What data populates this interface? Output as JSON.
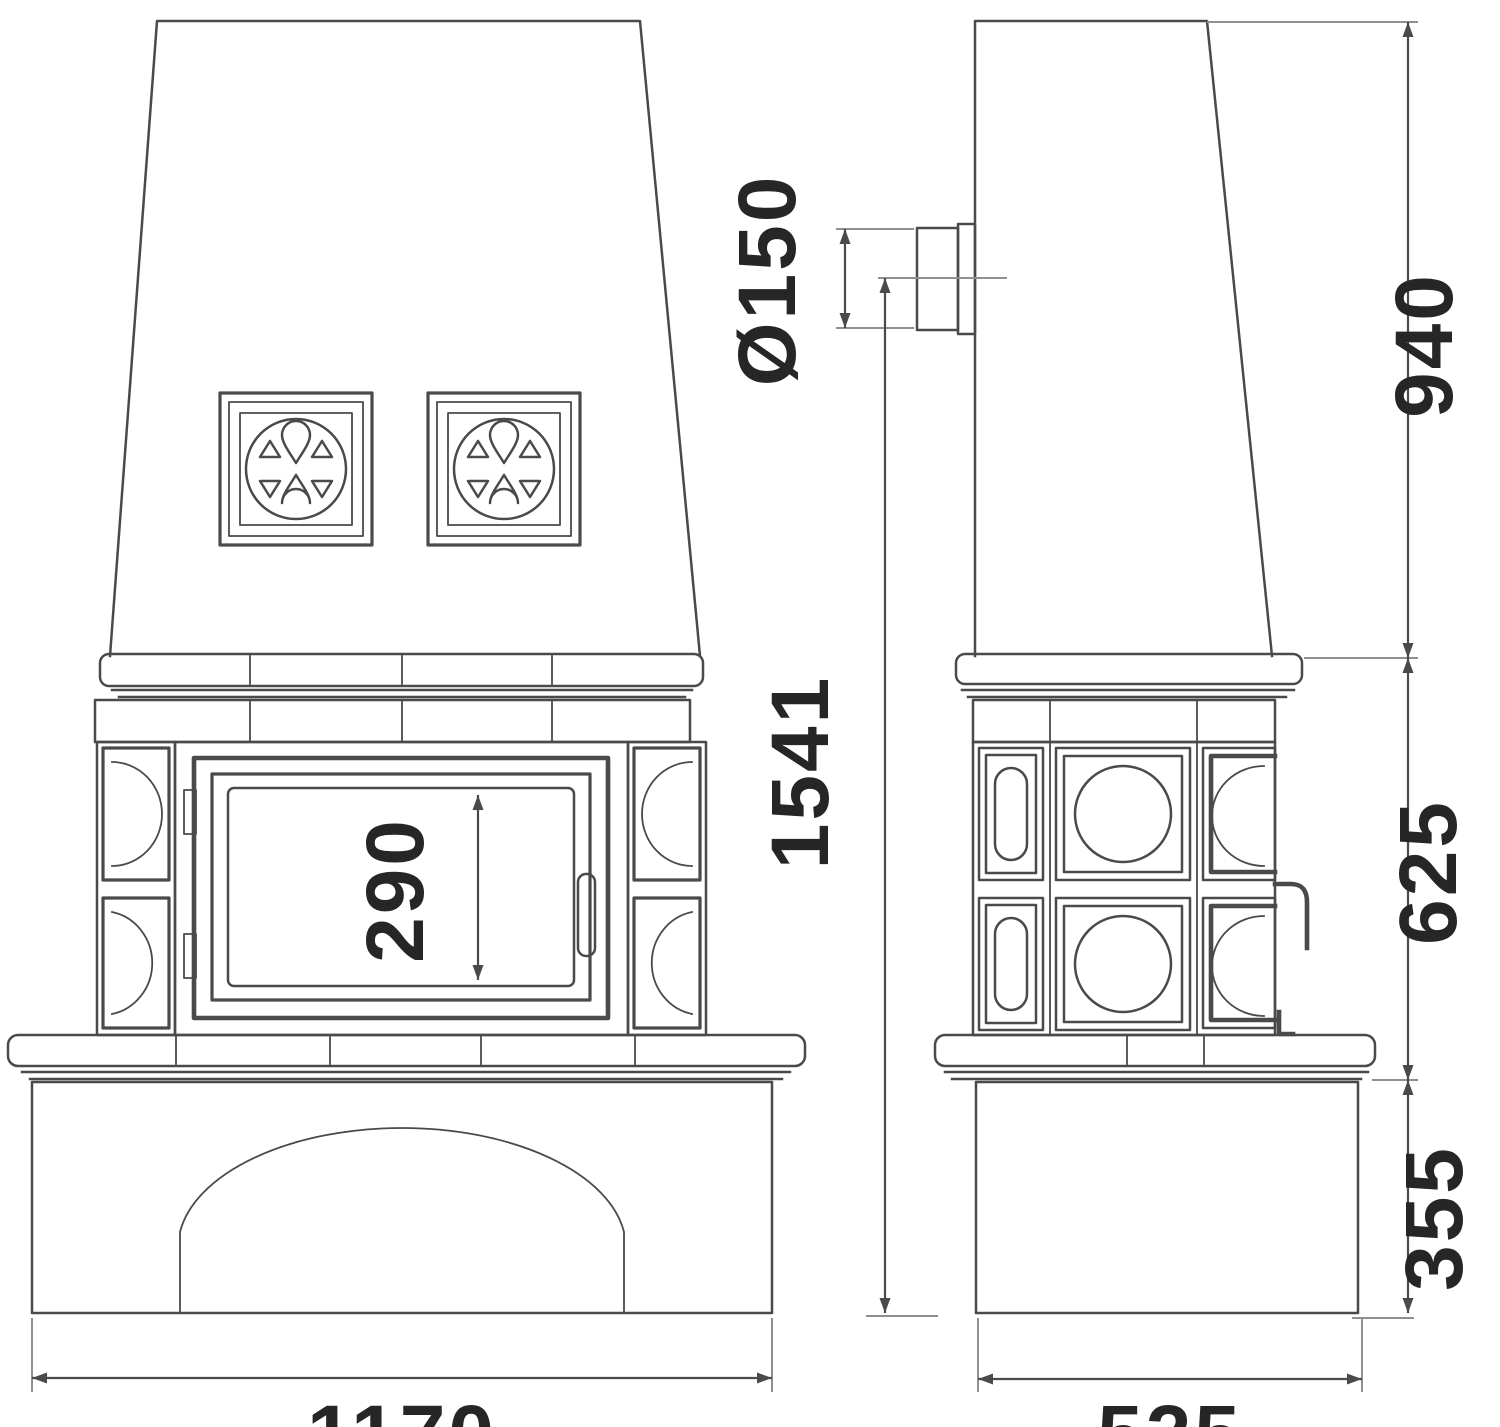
{
  "colors": {
    "background": "#ffffff",
    "line": "#4a4a4a",
    "dim_line": "#8f8f8f",
    "hatch": "#5a5a5a",
    "text": "#262626"
  },
  "dimensions": {
    "flue_diameter": "Ø150",
    "upper_height": "940",
    "total_height": "1541",
    "door_opening_height": "290",
    "middle_height": "625",
    "base_height": "355",
    "front_width": "1170",
    "side_depth": "525"
  }
}
